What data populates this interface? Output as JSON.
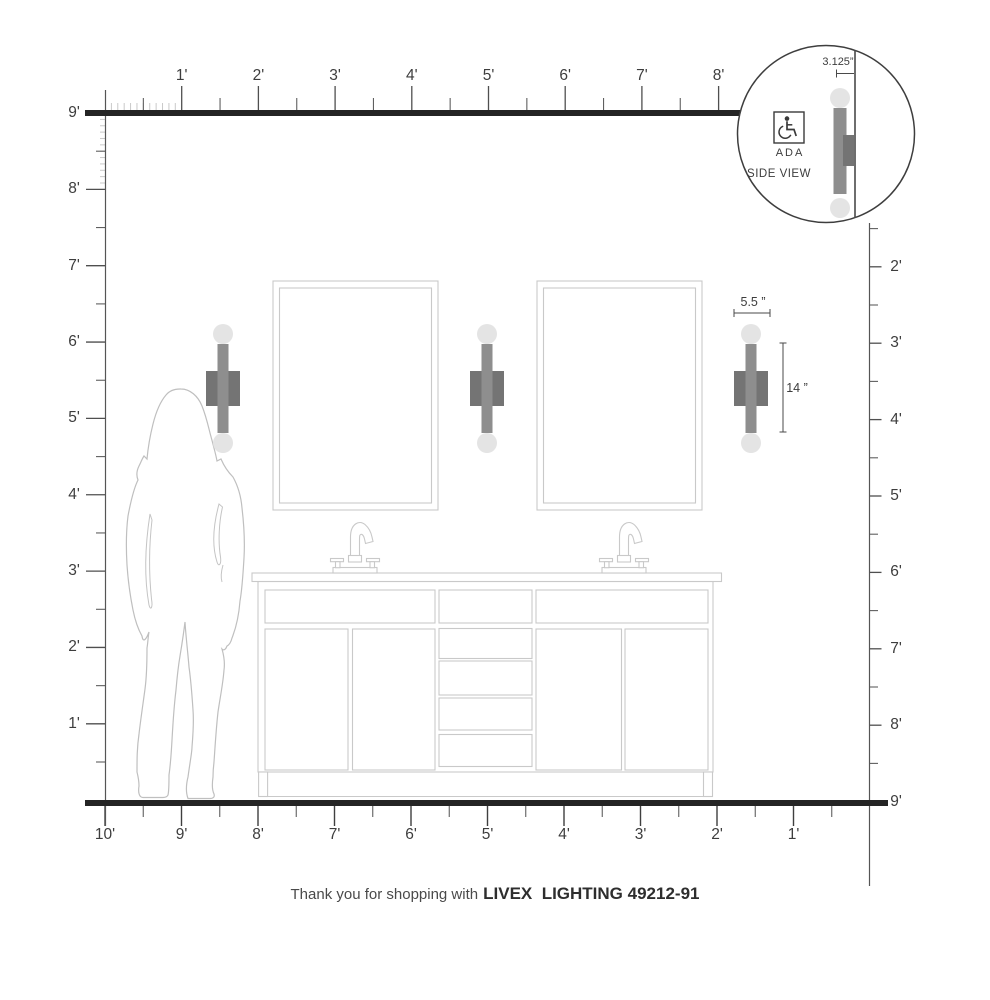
{
  "rulers": {
    "top": {
      "labels": [
        "1'",
        "2'",
        "3'",
        "4'",
        "5'",
        "6'",
        "7'",
        "8'"
      ]
    },
    "left": {
      "labels": [
        "9'",
        "8'",
        "7'",
        "6'",
        "5'",
        "4'",
        "3'",
        "2'",
        "1'"
      ]
    },
    "right": {
      "labels": [
        "2'",
        "3'",
        "4'",
        "5'",
        "6'",
        "7'",
        "8'",
        "9'"
      ]
    },
    "bottom": {
      "labels": [
        "10'",
        "9'",
        "8'",
        "7'",
        "6'",
        "5'",
        "4'",
        "3'",
        "2'",
        "1'"
      ]
    }
  },
  "detail_circle": {
    "dimension_label": "3.125”",
    "ada_label": "ADA",
    "view_label": "SIDE VIEW"
  },
  "fixture_dimensions": {
    "width_label": "5.5 ”",
    "height_label": "14 ”"
  },
  "caption": {
    "prefix": "Thank you for shopping with",
    "brand": "LIVEX  LIGHTING 49212-91"
  },
  "colors": {
    "floor_wall_line": "#242424",
    "ruler_line": "#555555",
    "tick_major": "#4f4f4f",
    "tick_inch": "#c9c9c9",
    "light_outline": "#c9c9c9",
    "sconce_bar": "#8e8e8e",
    "sconce_backplate": "#747474",
    "sconce_bulb": "#e4e4e4",
    "person_outline": "#bfbfbf"
  },
  "icons": {
    "ada": "wheelchair-icon"
  }
}
